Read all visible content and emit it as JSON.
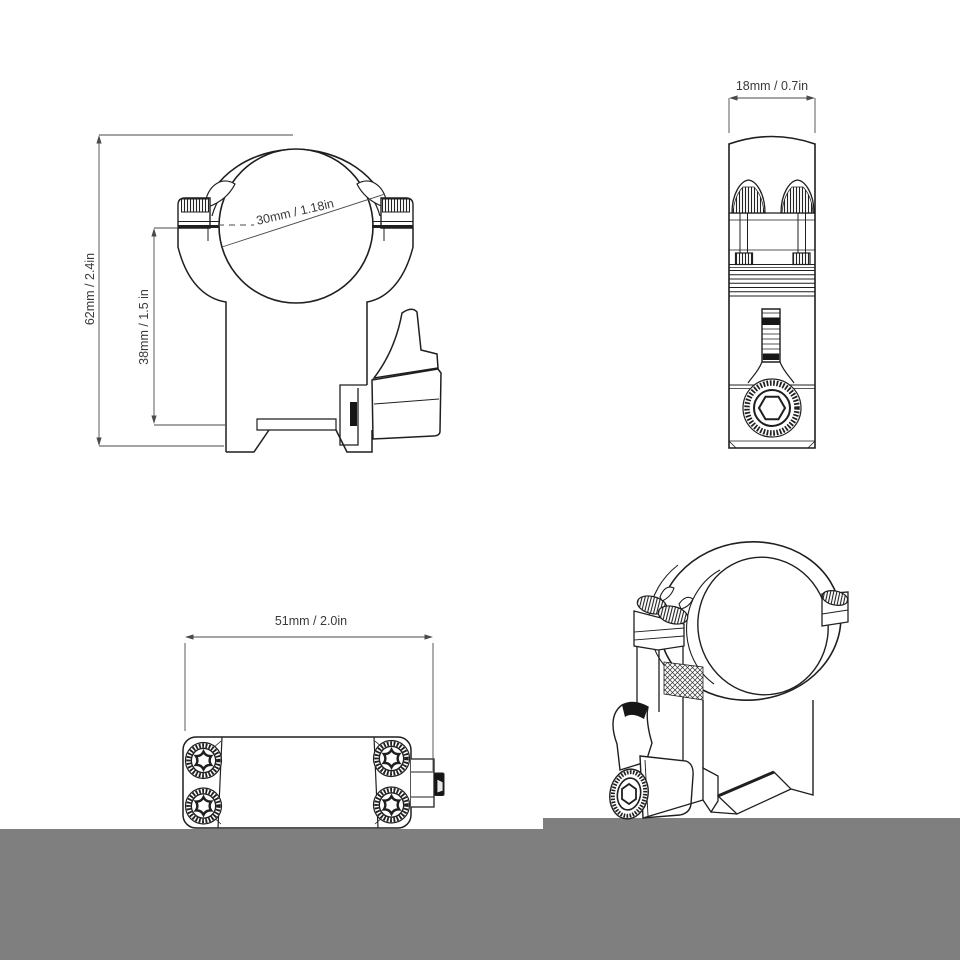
{
  "colors": {
    "background": "#ffffff",
    "floor": "#7f7f7f",
    "ink": "#1f1f1f",
    "dim_line": "#4a4a4a"
  },
  "views": {
    "front": {
      "label": "front-view",
      "dim_height": "62mm / 2.4in",
      "dim_saddle_height": "38mm / 1.5 in",
      "dim_ring_diameter": "30mm / 1.18in"
    },
    "side": {
      "label": "side-view",
      "dim_width": "18mm / 0.7in"
    },
    "bottom": {
      "label": "bottom-view",
      "dim_length": "51mm / 2.0in"
    },
    "perspective": {
      "label": "perspective-view"
    }
  }
}
